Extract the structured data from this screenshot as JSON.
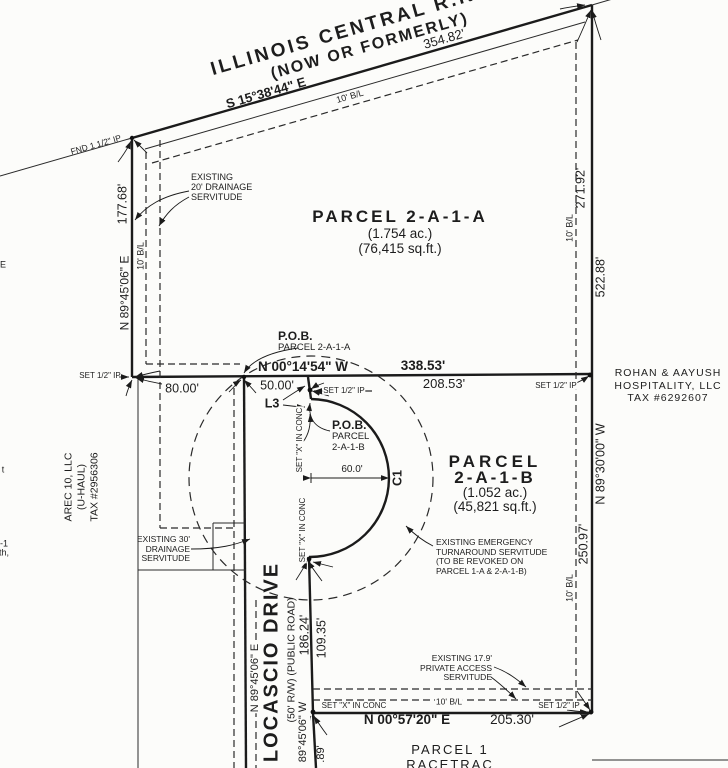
{
  "railroad": {
    "name": "ILLINOIS CENTRAL R.R. R/W",
    "formerly": "(NOW OR FORMERLY)",
    "bearing": "S 15°38'44\" E",
    "frontage_dim": "354.82'",
    "building_line": "10' B/L",
    "found_pin": "FND 1 1/2\" IP"
  },
  "west_side": {
    "dim_upper": "177.68'",
    "bearing": "N 89°45'06\" E",
    "building_line": "10' B/L",
    "set_pin": "SET 1/2\" IP",
    "drainage20": {
      "line1": "EXISTING",
      "line2": "20' DRAINAGE",
      "line3": "SERVITUDE"
    },
    "drainage30": {
      "line1": "EXISTING 30'",
      "line2": "DRAINAGE",
      "line3": "SERVITUDE"
    },
    "owner": {
      "line1": "AREC 10, LLC",
      "line2": "(U-HAUL)",
      "line3": "TAX #2956306"
    },
    "edge_fragments": {
      "f1": "E",
      "f2": "t",
      "f3": "-1",
      "f4": "th,"
    }
  },
  "parcel_a": {
    "name": "PARCEL 2-A-1-A",
    "acreage": "(1.754 ac.)",
    "square_feet": "(76,415 sq.ft.)",
    "pob": {
      "line1": "P.O.B.",
      "line2": "PARCEL 2-A-1-A"
    }
  },
  "division_line": {
    "bearing": "N 00°14'54\" W",
    "dim_total": "338.53'",
    "dim_west": "80.00'",
    "dim_road": "50.00'",
    "dim_east": "208.53'",
    "set_pin": "SET 1/2\" IP",
    "line_label": "L3"
  },
  "parcel_b": {
    "name_line1": "PARCEL",
    "name_line2": "2-A-1-B",
    "acreage": "(1.052 ac.)",
    "square_feet": "(45,821 sq.ft.)",
    "pob": {
      "line1": "P.O.B.",
      "line2": "PARCEL",
      "line3": "2-A-1-B"
    },
    "set_x_upper": "SET \"X\" IN CONC",
    "set_x_lower": "SET \"X\" IN CONC",
    "radius_dim": "60.0'",
    "curve_label": "C1",
    "turnaround": {
      "line1": "EXISTING EMERGENCY",
      "line2": "TURNAROUND SERVITUDE",
      "line3": "(TO BE REVOKED ON",
      "line4": "PARCEL 1-A & 2-A-1-B)"
    }
  },
  "east_side": {
    "dim_upper": "271.92'",
    "dim_total": "522.88'",
    "dim_lower": "250.97'",
    "bearing": "N 89°30'00\" W",
    "building_line_upper": "10' B/L",
    "building_line_lower": "10' B/L",
    "set_pin": "SET 1/2\" IP",
    "owner": {
      "line1": "ROHAN & AAYUSH",
      "line2": "HOSPITALITY, LLC",
      "line3": "TAX #6292607"
    }
  },
  "road": {
    "name": "LOCASCIO DRIVE",
    "subtitle": "(50' R/W) (PUBLIC ROAD)",
    "dim_total": "186.24'",
    "dim_lower": "109.35'",
    "bearing_west": "N 89°45'06\" E",
    "bearing_south": "89°45'06\" W",
    "dim_south_fragment": ".89'"
  },
  "south_side": {
    "bearing": "N 00°57'20\" E",
    "dim": "205.30'",
    "set_x": "SET \"X\" IN CONC",
    "building_line": "10' B/L",
    "set_pin": "SET 1/2\" IP",
    "access": {
      "line1": "EXISTING 17.9'",
      "line2": "PRIVATE ACCESS",
      "line3": "SERVITUDE"
    },
    "neighbor": {
      "line1": "PARCEL 1",
      "line2": "RACETRAC",
      "line3": "PETROLEUM, INC."
    }
  }
}
